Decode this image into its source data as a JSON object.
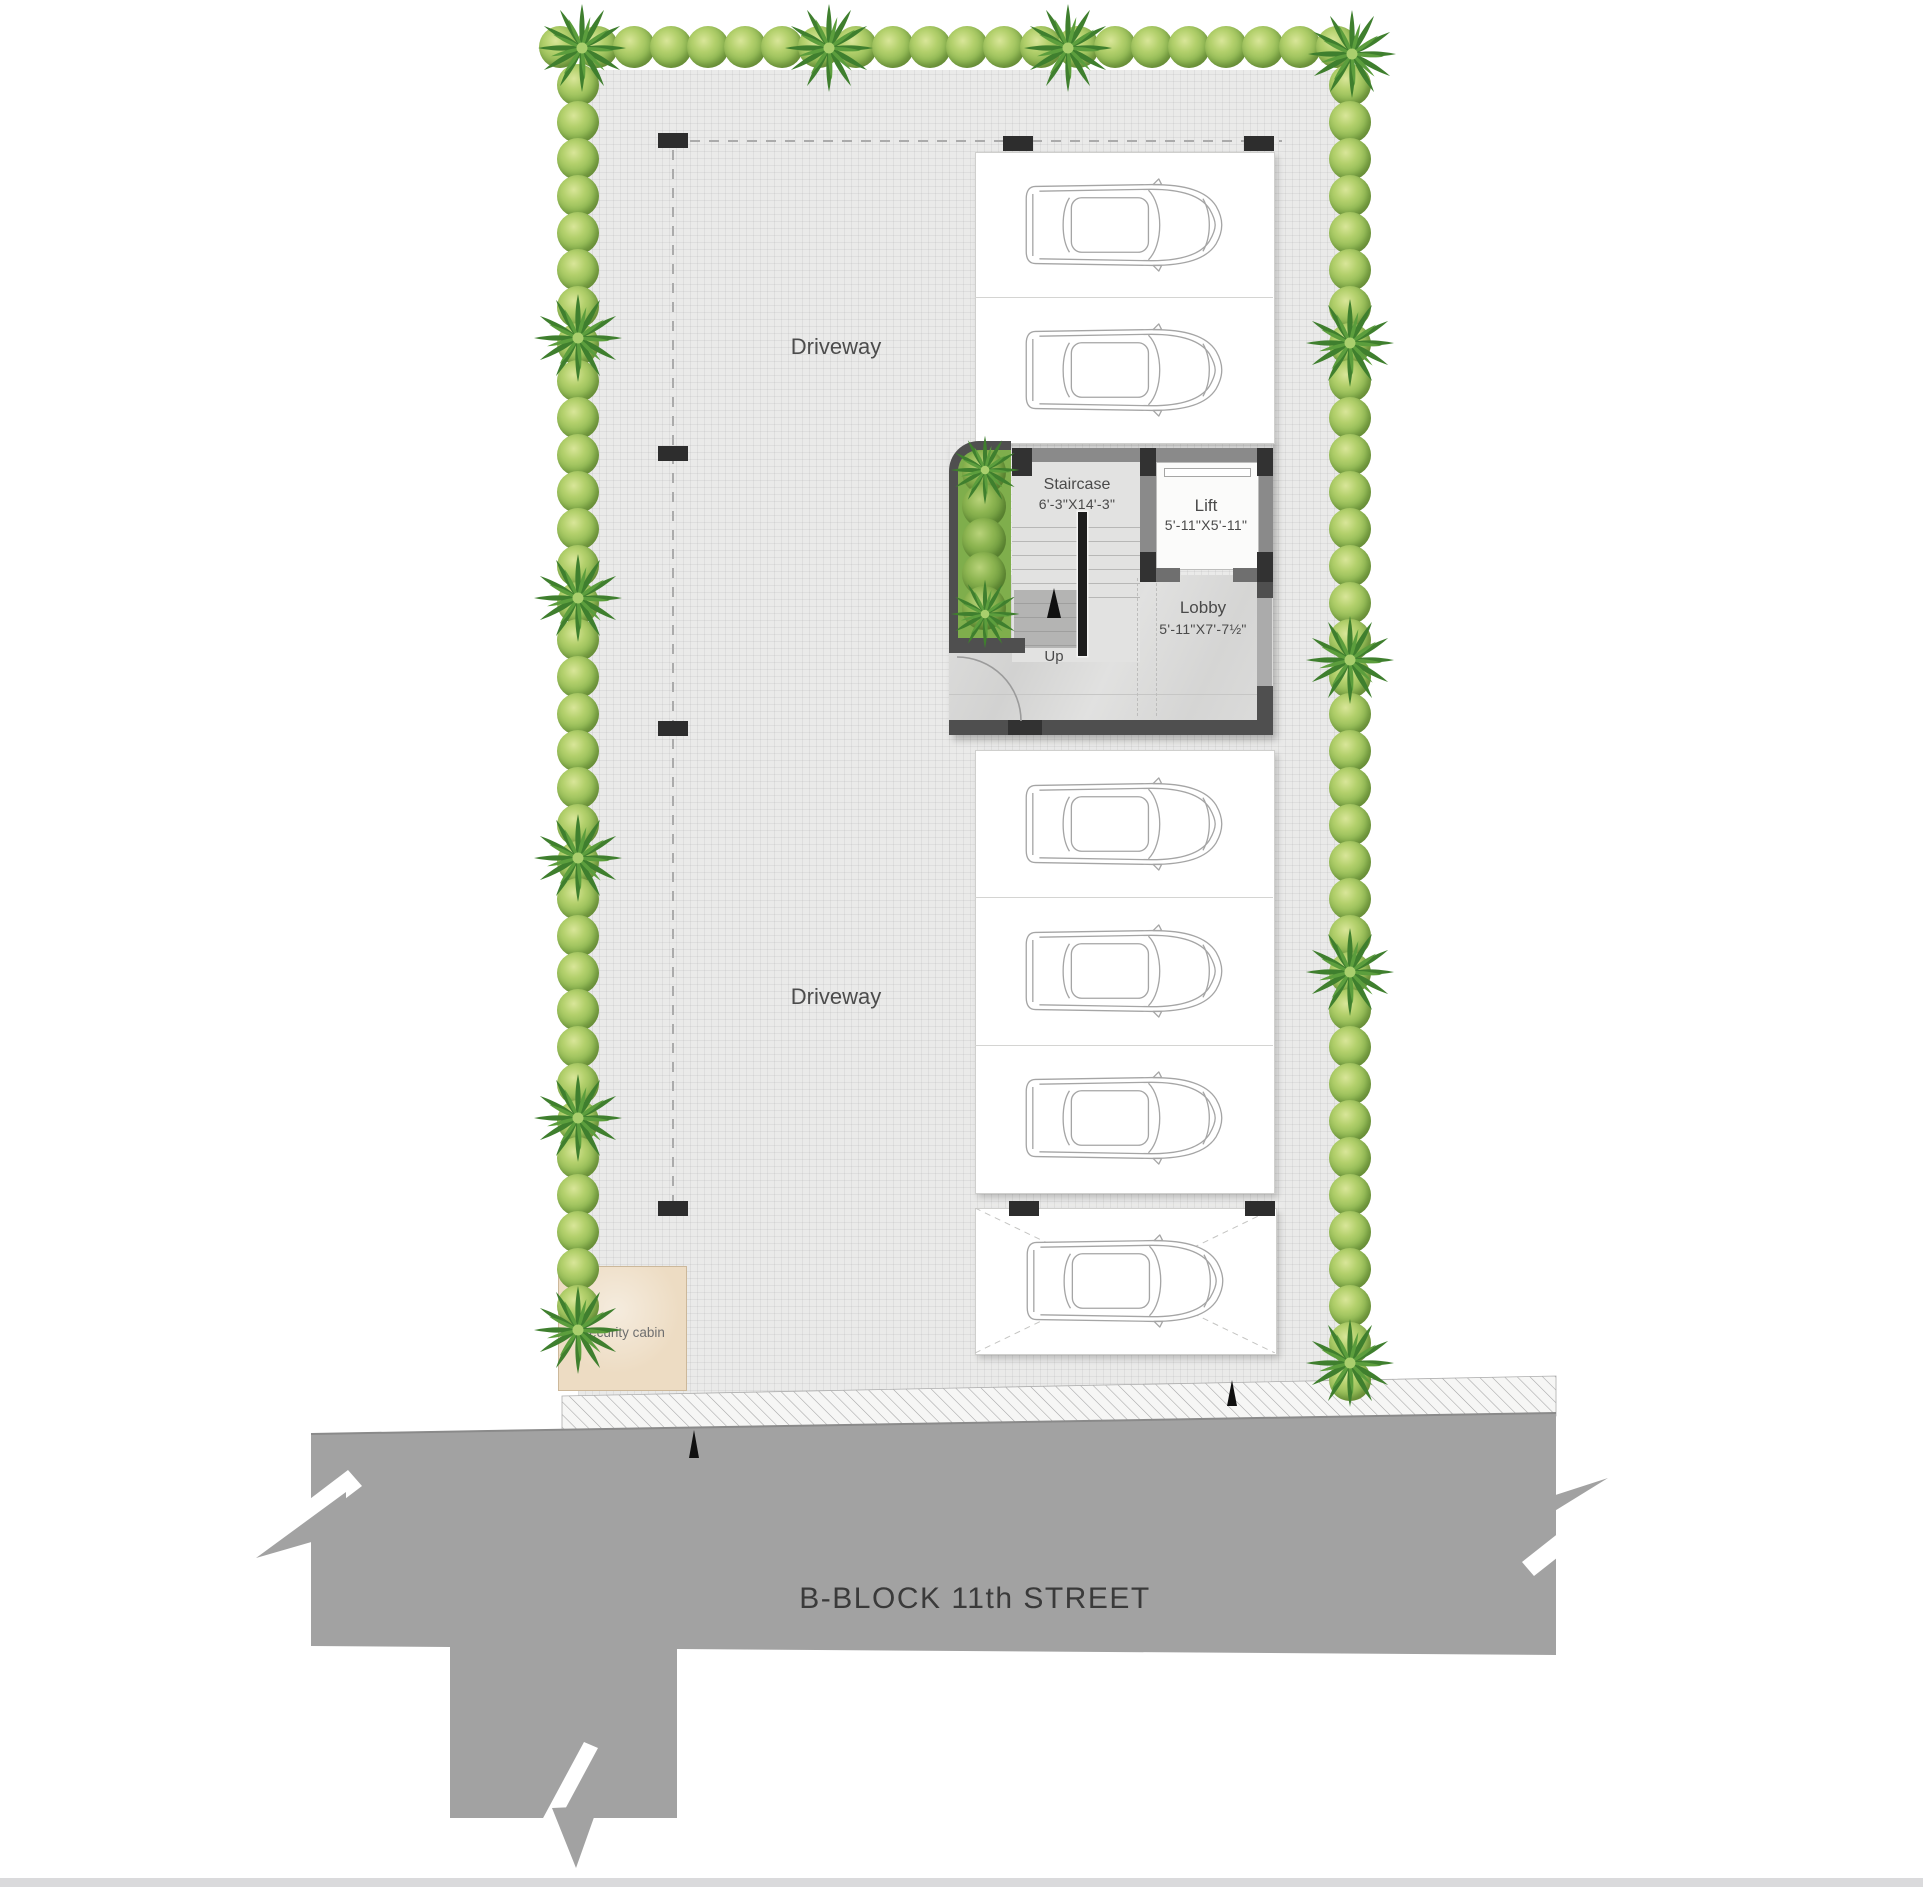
{
  "labels": {
    "driveway": "Driveway",
    "up": "Up",
    "security_cabin": "Security cabin",
    "street": "B-BLOCK 11th STREET"
  },
  "rooms": {
    "staircase": {
      "label": "Staircase",
      "dims": "6'-3\"X14'-3\""
    },
    "lift": {
      "label": "Lift",
      "dims": "5'-11\"X5'-11\""
    },
    "lobby": {
      "label": "Lobby",
      "dims": "5'-11\"X7'-7½\""
    }
  },
  "parking": {
    "top_group_spots": 2,
    "middle_group_spots": 3,
    "bottom_group_spots": 1,
    "total_cars": 6,
    "bottom_spot_marked_x": true
  },
  "icons": {
    "car": "car-top-view-icon",
    "bush": "bush-icon",
    "palm": "palm-tree-icon",
    "up_arrow": "up-arrow-icon",
    "entrance_arrow": "entrance-arrow-icon",
    "door_swing": "door-swing-arc"
  },
  "colors": {
    "paving": "#eaeae9",
    "street": "#a2a2a2",
    "hedge_green": "#8fb853",
    "palm_green": "#4e9038",
    "wall_dark": "#4f4f4f",
    "planter_green": "#7fae4c",
    "cabin_beige": "#eddcc3"
  }
}
